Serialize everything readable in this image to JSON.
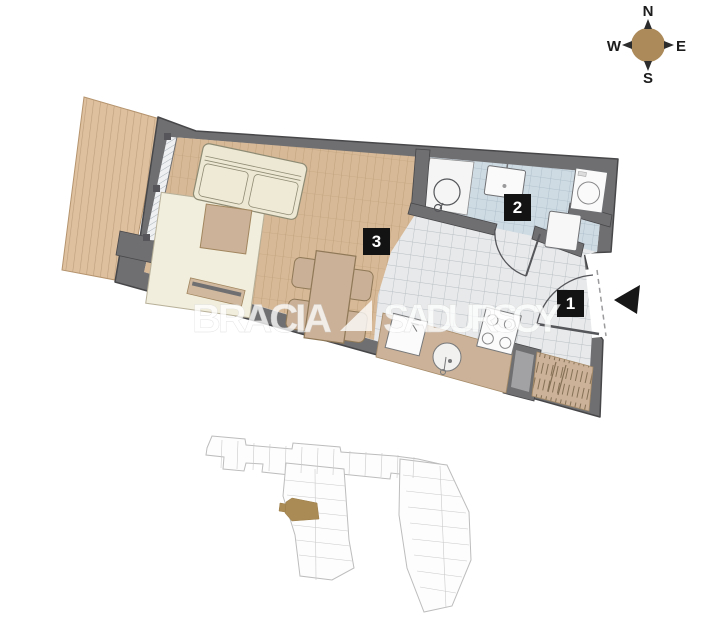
{
  "compass": {
    "labels": {
      "north": "N",
      "east": "E",
      "south": "S",
      "west": "W"
    },
    "color": "#ac8a59"
  },
  "watermark": {
    "brand_left": "BRACIA",
    "brand_right": "SADURSCY"
  },
  "floorplan": {
    "rooms": [
      {
        "number": "1",
        "name": "hallway"
      },
      {
        "number": "2",
        "name": "bathroom"
      },
      {
        "number": "3",
        "name": "living-room-with-kitchenette"
      }
    ],
    "colors": {
      "wall": "#6f6f71",
      "wood_floor": "#d7b997",
      "terrace_deck": "#dec09f",
      "hall_tiles": "#e8e9ea",
      "bath_tiles": "#cfdbe3",
      "furniture_tan": "#cbb298",
      "badge": "#131313",
      "arrow": "#171717"
    }
  },
  "site_plan": {
    "highlight_color": "#aa8b55"
  }
}
